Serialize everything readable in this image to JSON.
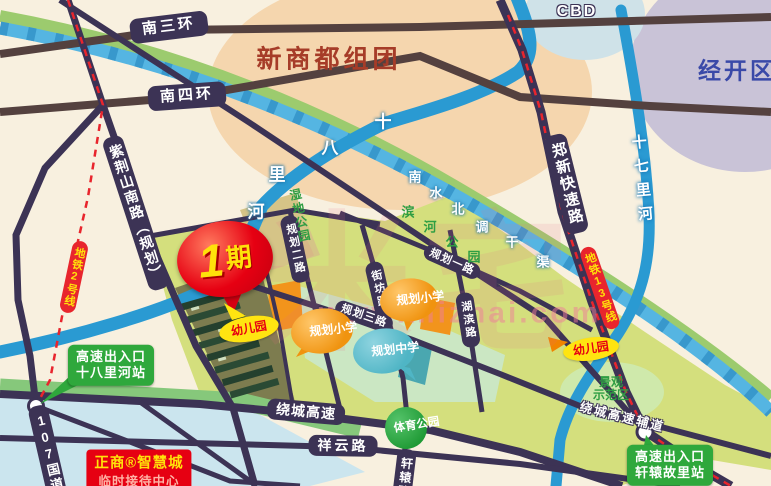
{
  "areas": {
    "cbd": "CBD",
    "jingkai": "经开区",
    "xinshangdu": "新商都组团"
  },
  "roads": {
    "nansanhuan": "南三环",
    "nansihuan": "南四环",
    "zijingshan": "紫荆山南路（规划）",
    "zhengxin": "郑新快速路",
    "guodao107": "107国道",
    "raocheng": "绕城高速",
    "raocheng_fudao": "绕城高速辅道",
    "xiangyun": "祥云路",
    "xuanyuan": "轩辕路",
    "guihua1": "规划一路",
    "guihua2": "规划二路",
    "guihua3": "规划三路",
    "jiefang": "街坊路",
    "hubin": "湖滨路"
  },
  "metro": {
    "line2": "地铁2号线",
    "line13": "地铁13号线"
  },
  "waters": {
    "shibalihe": "十八里河",
    "shiqilihe": "十七里河",
    "canal": "南水北调干渠"
  },
  "parks": {
    "shidi": "湿地公园",
    "binhe": "滨河公园",
    "tiyu": "体育公园",
    "jingguan_l1": "景观",
    "jingguan_l2": "示范区"
  },
  "poi": {
    "phase1_num": "1",
    "phase1_unit": "期",
    "kindergarten": "幼儿园",
    "primary_school": "规划小学",
    "middle_school": "规划中学"
  },
  "exits": {
    "gaosu": "高速出入口",
    "station_shibalihe": "十八里河站",
    "station_xuanyuan": "轩辕故里站"
  },
  "sales_office": {
    "line1": "正商®智慧城",
    "line2": "临时接待中心"
  },
  "watermark": {
    "logo": "米宅",
    "url": "www.mizhai.com"
  },
  "colors": {
    "road": "#3c3355",
    "ring_road": "#54413f",
    "river": "#2a9ad2",
    "canal": "#55b5e2",
    "metro_red": "#e8252d",
    "badge_green": "#2fa83c",
    "badge_red": "#e60012",
    "badge_yellow": "#ffe411",
    "badge_orange": "#f0930f",
    "badge_teal": "#4fb5c5",
    "zone_green": "#d4df7d"
  }
}
